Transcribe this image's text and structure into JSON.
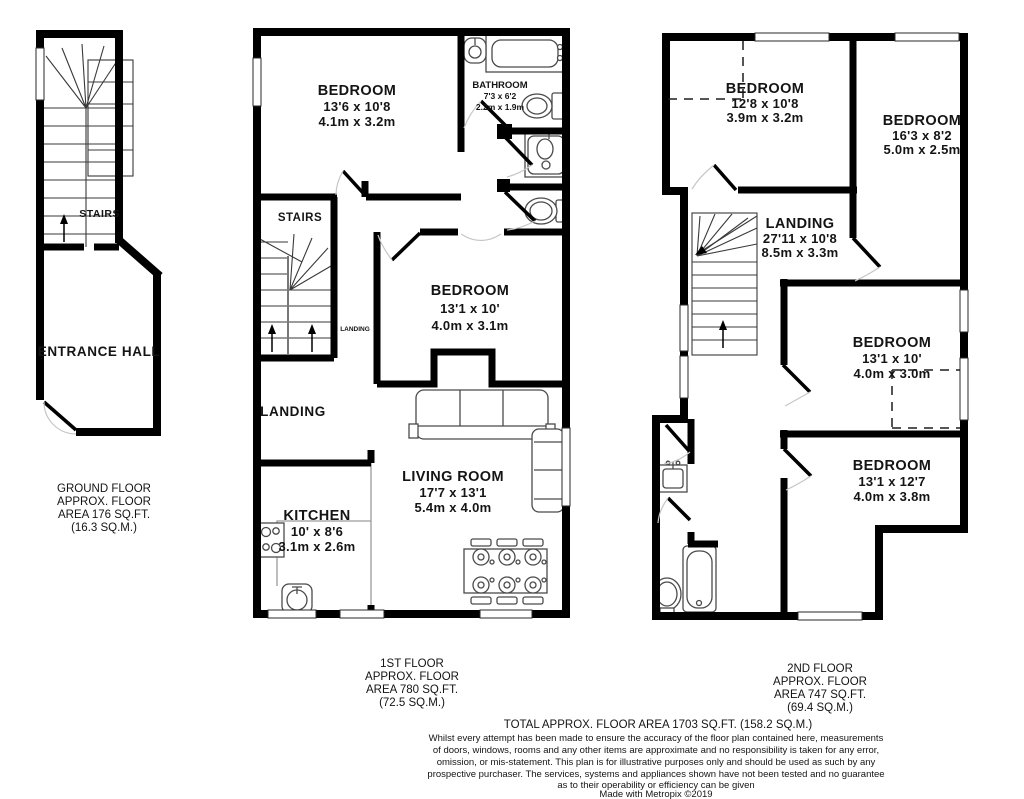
{
  "ground_floor": {
    "stairs_label": "STAIRS",
    "room_label": "ENTRANCE HALL",
    "area_lines": [
      "GROUND FLOOR",
      "APPROX. FLOOR",
      "AREA 176 SQ.FT.",
      "(16.3 SQ.M.)"
    ]
  },
  "first_floor": {
    "bedroom_front": {
      "name": "BEDROOM",
      "imperial": "13'6 x 10'8",
      "metric": "4.1m x 3.2m"
    },
    "bathroom": {
      "name": "BATHROOM",
      "imperial": "7'3 x 6'2",
      "metric": "2.2m x 1.9m"
    },
    "stairs_label": "STAIRS",
    "landing_small": "LANDING",
    "bedroom_mid": {
      "name": "BEDROOM",
      "imperial": "13'1 x 10'",
      "metric": "4.0m x 3.1m"
    },
    "landing_label": "LANDING",
    "kitchen": {
      "name": "KITCHEN",
      "imperial": "10' x 8'6",
      "metric": "3.1m x 2.6m"
    },
    "living_room": {
      "name": "LIVING ROOM",
      "imperial": "17'7 x 13'1",
      "metric": "5.4m x 4.0m"
    },
    "area_lines": [
      "1ST FLOOR",
      "APPROX. FLOOR",
      "AREA 780 SQ.FT.",
      "(72.5 SQ.M.)"
    ]
  },
  "second_floor": {
    "bedroom_tl": {
      "name": "BEDROOM",
      "imperial": "12'8 x 10'8",
      "metric": "3.9m x 3.2m"
    },
    "bedroom_tr": {
      "name": "BEDROOM",
      "imperial": "16'3 x 8'2",
      "metric": "5.0m x 2.5m"
    },
    "landing": {
      "name": "LANDING",
      "imperial": "27'11 x 10'8",
      "metric": "8.5m x 3.3m"
    },
    "bedroom_mr": {
      "name": "BEDROOM",
      "imperial": "13'1 x 10'",
      "metric": "4.0m x 3.0m"
    },
    "bedroom_br": {
      "name": "BEDROOM",
      "imperial": "13'1 x 12'7",
      "metric": "4.0m x 3.8m"
    },
    "area_lines": [
      "2ND FLOOR",
      "APPROX. FLOOR",
      "AREA 747 SQ.FT.",
      "(69.4 SQ.M.)"
    ]
  },
  "footer": {
    "total": "TOTAL APPROX. FLOOR AREA 1703 SQ.FT. (158.2 SQ.M.)",
    "disclaimer_lines": [
      "Whilst every attempt has been made to ensure the accuracy of the floor plan contained here, measurements",
      "of doors, windows, rooms and any other items are approximate and no responsibility is taken for any error,",
      "omission, or mis-statement. This plan is for illustrative purposes only and should be used as such by any",
      "prospective purchaser. The services, systems and appliances shown have not been tested and no guarantee",
      "as to their operability or efficiency can be given"
    ],
    "credit": "Made with Metropix ©2019"
  }
}
